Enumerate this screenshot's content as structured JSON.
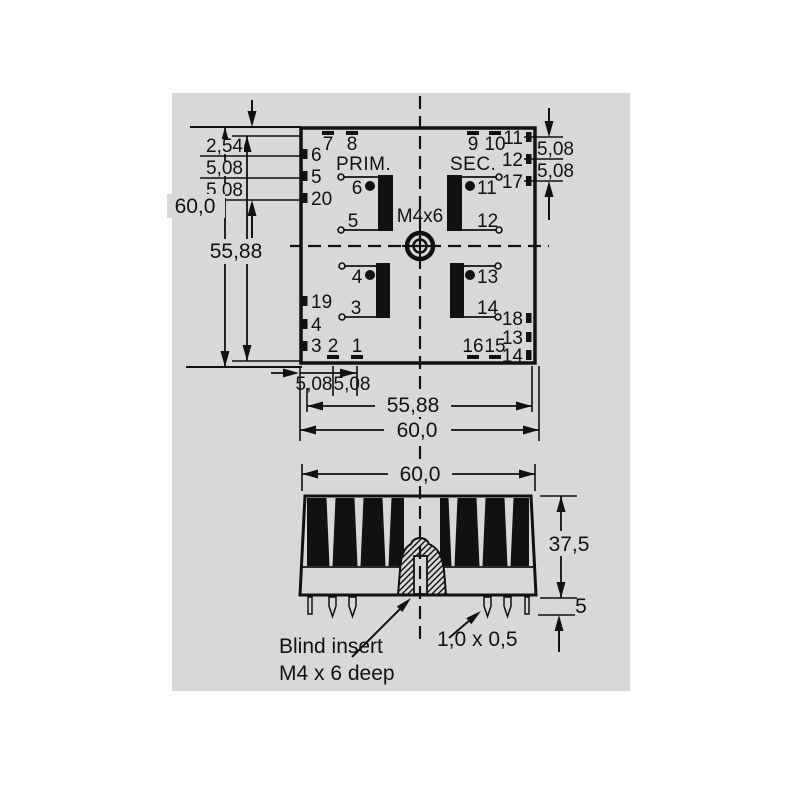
{
  "colors": {
    "panel_bg": "#d8d8d8",
    "line": "#111111"
  },
  "top_view": {
    "prim_label": "PRIM.",
    "sec_label": "SEC.",
    "insert_label": "M4x6",
    "windings": {
      "prim_upper_start": "6",
      "prim_upper_end": "5",
      "sec_upper_start": "11",
      "sec_upper_end": "12",
      "prim_lower_start": "4",
      "prim_lower_end": "3",
      "sec_lower_start": "13",
      "sec_lower_end": "14"
    },
    "pins": {
      "left_6": "6",
      "left_5": "5",
      "left_20": "20",
      "left_19": "19",
      "left_4": "4",
      "left_3": "3",
      "top_7": "7",
      "top_8": "8",
      "top_9": "9",
      "top_10": "10",
      "right_11": "11",
      "right_12": "12",
      "right_17": "17",
      "right_18": "18",
      "right_13": "13",
      "right_14": "14",
      "bottom_2": "2",
      "bottom_1": "1",
      "bottom_16": "16",
      "bottom_15": "15"
    },
    "dims": {
      "row_pitch_1": "2,54",
      "row_pitch_2": "5,08",
      "row_pitch_3": "5,08",
      "height_outer": "60,0",
      "height_grid": "55,88",
      "right_pitch_1": "5,08",
      "right_pitch_2": "5,08",
      "col_pitch_1": "5,08",
      "col_pitch_2": "5,08",
      "width_grid": "55,88",
      "width_outer": "60,0"
    }
  },
  "side_view": {
    "dims": {
      "width": "60,0",
      "body_height": "37,5",
      "pin_length": "5",
      "pin_cross_section": "1,0 x 0,5"
    },
    "note_line1": "Blind insert",
    "note_line2": "M4 x 6 deep"
  }
}
